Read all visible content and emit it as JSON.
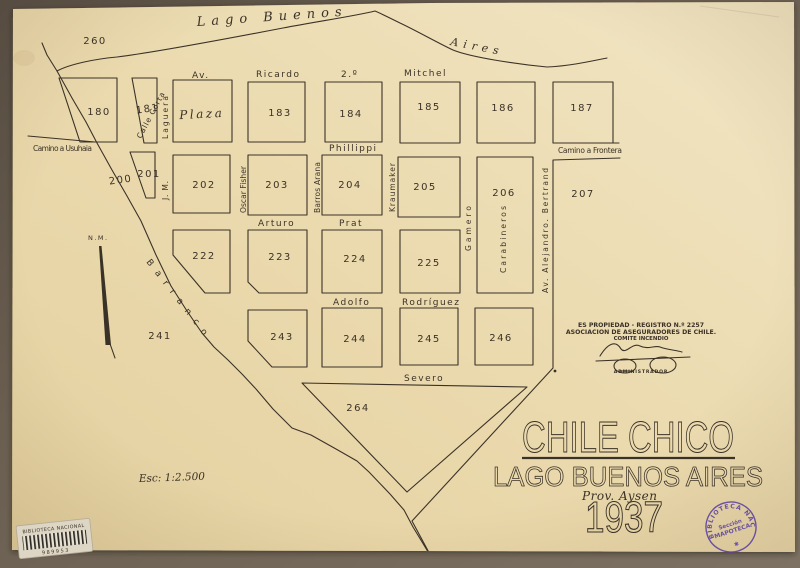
{
  "colors": {
    "paper": "#ebdaae",
    "ink": "#3b3227",
    "mat": "#6b5f51",
    "stamp_purple": "#5b3fa0"
  },
  "lake": {
    "label_a": "Lago Buenos",
    "label_b": "Aires"
  },
  "landmarks": {
    "north_marker": "N.M.",
    "ravine": "Barranco",
    "plaza": "Plaza",
    "scale": "Esc: 1:2.500",
    "point_260": "260"
  },
  "roads": {
    "camino_usuhaia": "Camino a Usuhaia",
    "camino_frontera": "Camino a Frontera"
  },
  "streets": {
    "av": "Av.",
    "ricardo": "Ricardo",
    "segundo": "2.º",
    "mitchel": "Mitchel",
    "phillippi": "Phillippi",
    "arturo": "Arturo",
    "prat": "Prat",
    "adolfo": "Adolfo",
    "rodriguez": "Rodríguez",
    "severo": "Severo",
    "calle_corta": "Calle Corta",
    "laguera": "Laguera",
    "jm": "J. M.",
    "oscar_fisher": "Oscar Fisher",
    "barros_arana": "Barros Arana",
    "kraumaker": "Kraumaker",
    "gamero": "Gamero",
    "carabineros": "Carabineros",
    "av_bertrand": "Av. Alejandro. Bertrand"
  },
  "blocks": {
    "b180": "180",
    "b181": "181",
    "b183": "183",
    "b184": "184",
    "b185": "185",
    "b186": "186",
    "b187": "187",
    "b200": "200",
    "b201": "201",
    "b202": "202",
    "b203": "203",
    "b204": "204",
    "b205": "205",
    "b206": "206",
    "b207": "207",
    "b222": "222",
    "b223": "223",
    "b224": "224",
    "b225": "225",
    "b241": "241",
    "b243": "243",
    "b244": "244",
    "b245": "245",
    "b246": "246",
    "b264": "264"
  },
  "registry": {
    "line1": "ES PROPIEDAD - REGISTRO N.º 2257",
    "line2": "ASOCIACION DE ASEGURADORES DE CHILE.",
    "line3": "COMITE INCENDIO",
    "signer": "ADMINISTRADOR"
  },
  "title": {
    "main": "CHILE CHICO",
    "subtitle": "LAGO BUENOS AIRES",
    "province": "Prov. Aysen",
    "year": "1937"
  },
  "library": {
    "sticker_title": "BIBLIOTECA NACIONAL",
    "sticker_number": "989953",
    "stamp_ring": "BIBLIOTECA  NACIONAL",
    "stamp_center_1": "Sección",
    "stamp_center_2": "MAPOTECA",
    "stamp_star": "✱"
  }
}
